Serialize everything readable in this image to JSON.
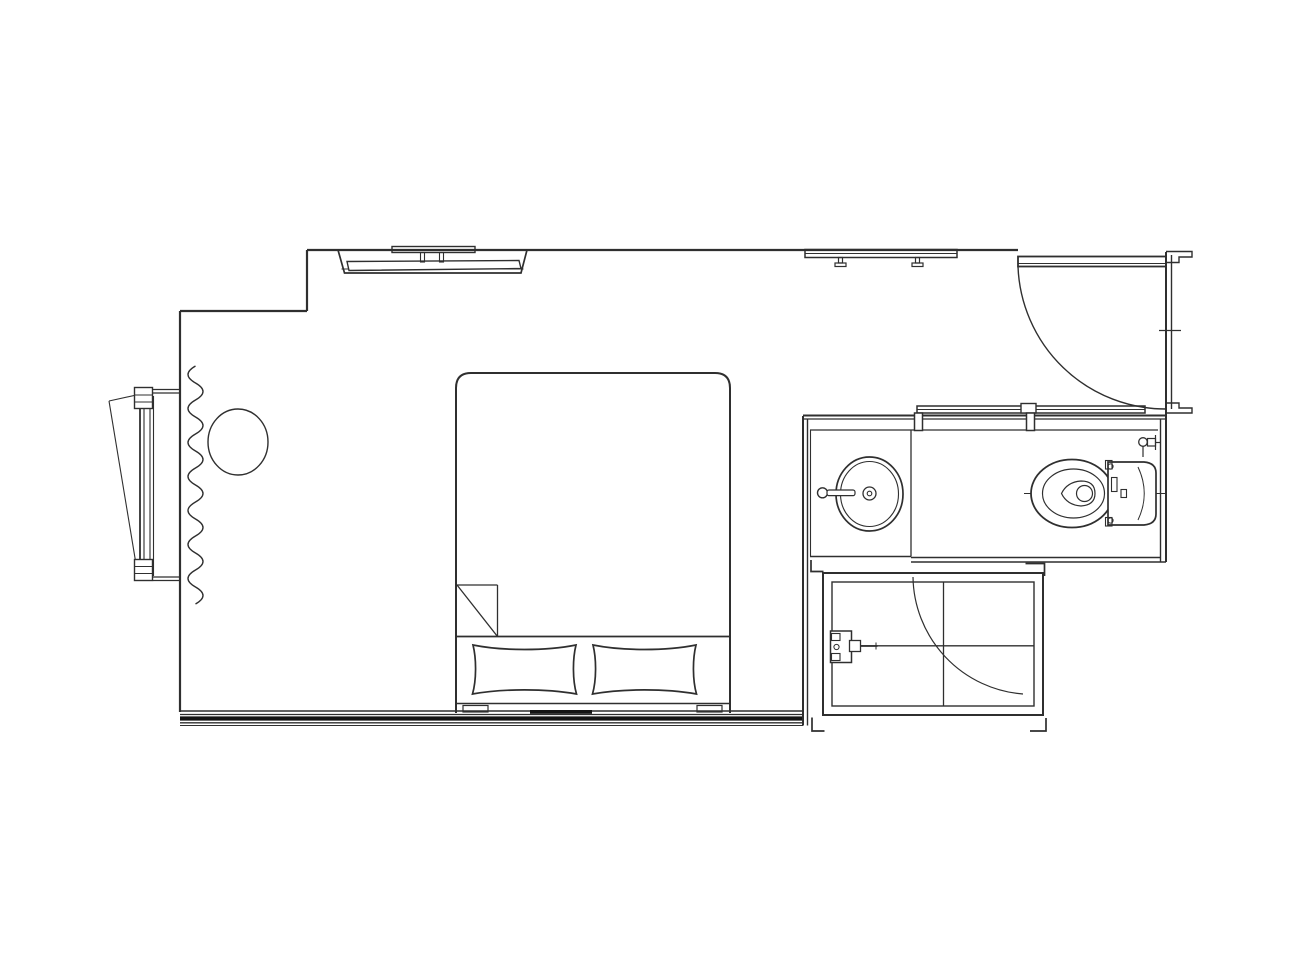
{
  "meta": {
    "description": "architectural floor plan line drawing, hotel guest room with bathroom and shower",
    "background": "#ffffff",
    "stroke": "#2f2f2f",
    "stroke_dark": "#141414",
    "canvas_width": 1300,
    "canvas_height": 975
  },
  "elements": [
    {
      "name": "bedroom-walls",
      "shapes": [
        {
          "type": "line",
          "x1": 307,
          "y1": 250,
          "x2": 1018,
          "y2": 250,
          "sw": 2.2
        },
        {
          "type": "line",
          "x1": 307,
          "y1": 250,
          "x2": 307,
          "y2": 311,
          "sw": 2.2
        },
        {
          "type": "line",
          "x1": 180,
          "y1": 311,
          "x2": 307,
          "y2": 311,
          "sw": 2.2
        },
        {
          "type": "line",
          "x1": 180,
          "y1": 311,
          "x2": 180,
          "y2": 712,
          "sw": 2.2
        }
      ]
    },
    {
      "name": "bottom-wall",
      "shapes": [
        {
          "type": "line",
          "x1": 180,
          "y1": 711,
          "x2": 803,
          "y2": 711,
          "sw": 1.6
        },
        {
          "type": "line",
          "x1": 180,
          "y1": 714.5,
          "x2": 803,
          "y2": 714.5,
          "sw": 1.2
        },
        {
          "type": "line",
          "x1": 180,
          "y1": 718.5,
          "x2": 803,
          "y2": 718.5,
          "sw": 4.2,
          "stroke": "#141414"
        },
        {
          "type": "line",
          "x1": 180,
          "y1": 722.8,
          "x2": 803,
          "y2": 722.8,
          "sw": 1.3
        },
        {
          "type": "line",
          "x1": 180,
          "y1": 725.5,
          "x2": 803,
          "y2": 725.5,
          "sw": 1.1
        }
      ]
    },
    {
      "name": "bedroom-right-wall",
      "shapes": [
        {
          "type": "line",
          "x1": 803,
          "y1": 416,
          "x2": 803,
          "y2": 725.5,
          "sw": 2
        },
        {
          "type": "line",
          "x1": 807.5,
          "y1": 419,
          "x2": 807.5,
          "y2": 725.5,
          "sw": 1.4
        }
      ]
    },
    {
      "name": "bathroom-top-wall",
      "shapes": [
        {
          "type": "line",
          "x1": 803,
          "y1": 415.5,
          "x2": 1166,
          "y2": 415.5,
          "sw": 2
        },
        {
          "type": "line",
          "x1": 803,
          "y1": 419,
          "x2": 1166,
          "y2": 419,
          "sw": 1.3
        }
      ]
    },
    {
      "name": "bathroom-right-wall",
      "shapes": [
        {
          "type": "line",
          "x1": 1160.5,
          "y1": 419,
          "x2": 1160.5,
          "y2": 562,
          "sw": 1.4
        },
        {
          "type": "line",
          "x1": 1166,
          "y1": 412,
          "x2": 1166,
          "y2": 562,
          "sw": 2
        }
      ]
    },
    {
      "name": "bathroom-bottom-wall",
      "shapes": [
        {
          "type": "line",
          "x1": 810,
          "y1": 556.5,
          "x2": 911,
          "y2": 556.5,
          "sw": 1.5
        },
        {
          "type": "line",
          "x1": 911,
          "y1": 557.5,
          "x2": 1160,
          "y2": 557.5,
          "sw": 1.5
        },
        {
          "type": "line",
          "x1": 911,
          "y1": 562,
          "x2": 1166,
          "y2": 562,
          "sw": 1.6
        }
      ]
    },
    {
      "name": "bathroom-floor-lines",
      "shapes": [
        {
          "type": "line",
          "x1": 810,
          "y1": 430,
          "x2": 1158,
          "y2": 430,
          "sw": 1.3
        },
        {
          "type": "line",
          "x1": 911,
          "y1": 430,
          "x2": 911,
          "y2": 556.5,
          "sw": 1.3
        },
        {
          "type": "line",
          "x1": 810.5,
          "y1": 430,
          "x2": 810.5,
          "y2": 556.5,
          "sw": 1.1
        }
      ]
    },
    {
      "name": "sliding-door",
      "shapes": [
        {
          "type": "rect",
          "x": 917,
          "y": 406,
          "w": 228,
          "h": 7,
          "sw": 1.5
        },
        {
          "type": "line",
          "x1": 917,
          "y1": 409.5,
          "x2": 1145,
          "y2": 409.5,
          "sw": 0.9
        },
        {
          "type": "rect",
          "x": 1021,
          "y": 403.5,
          "w": 15,
          "h": 9.5,
          "sw": 1.4,
          "fill": "#ffffff"
        },
        {
          "type": "rect",
          "x": 914.5,
          "y": 413,
          "w": 8,
          "h": 17.5,
          "sw": 1.5,
          "fill": "#ffffff"
        },
        {
          "type": "rect",
          "x": 1026.5,
          "y": 413,
          "w": 8,
          "h": 17.5,
          "sw": 1.5,
          "fill": "#ffffff"
        }
      ]
    },
    {
      "name": "entry-door",
      "shapes": [
        {
          "type": "rect",
          "x": 1018,
          "y": 256.5,
          "w": 148,
          "h": 10,
          "sw": 1.8,
          "fill": "#ffffff"
        },
        {
          "type": "line",
          "x1": 1018,
          "y1": 263.5,
          "x2": 1166,
          "y2": 263.5,
          "sw": 1
        },
        {
          "type": "path",
          "d": "M1018 266.5 A148 148 0 0 0 1166 409",
          "sw": 1.4
        }
      ]
    },
    {
      "name": "entry-door-frame",
      "shapes": [
        {
          "type": "line",
          "x1": 1166,
          "y1": 252,
          "x2": 1166,
          "y2": 412,
          "sw": 2
        },
        {
          "type": "line",
          "x1": 1171.5,
          "y1": 255,
          "x2": 1171.5,
          "y2": 409,
          "sw": 1.4
        },
        {
          "type": "path",
          "d": "M1166 251.5 H1192 V257 H1179 V262.5 H1166",
          "sw": 1.4
        },
        {
          "type": "path",
          "d": "M1166 403 H1179 V408 H1192 V413 H1166",
          "sw": 1.4
        },
        {
          "type": "line",
          "x1": 1159,
          "y1": 330.5,
          "x2": 1181,
          "y2": 330.5,
          "sw": 1.3
        }
      ]
    },
    {
      "name": "closet-rod",
      "shapes": [
        {
          "type": "rect",
          "x": 805,
          "y": 249.5,
          "w": 152,
          "h": 8,
          "sw": 1.5
        },
        {
          "type": "line",
          "x1": 805,
          "y1": 253.5,
          "x2": 957,
          "y2": 253.5,
          "sw": 0.9
        },
        {
          "type": "rect",
          "x": 838.5,
          "y": 257.5,
          "w": 4,
          "h": 5.5,
          "sw": 1.2
        },
        {
          "type": "rect",
          "x": 835,
          "y": 263,
          "w": 11,
          "h": 3.5,
          "sw": 1.2
        },
        {
          "type": "rect",
          "x": 915.5,
          "y": 257.5,
          "w": 4,
          "h": 5.5,
          "sw": 1.2
        },
        {
          "type": "rect",
          "x": 912,
          "y": 263,
          "w": 11,
          "h": 3.5,
          "sw": 1.2
        }
      ]
    },
    {
      "name": "tv-unit",
      "shapes": [
        {
          "type": "path",
          "d": "M338 250 L344.5 273 L521 273 L527 250",
          "sw": 1.7
        },
        {
          "type": "line",
          "x1": 341.5,
          "y1": 269,
          "x2": 523.5,
          "y2": 269,
          "sw": 1.1
        },
        {
          "type": "polygon",
          "points": "347,261.5 519,260.5 521,268.5 349,270.5",
          "sw": 1.4,
          "fill": "#ffffff"
        },
        {
          "type": "rect",
          "x": 392,
          "y": 246.5,
          "w": 83,
          "h": 6,
          "sw": 1.4
        },
        {
          "type": "rect",
          "x": 420.5,
          "y": 252.5,
          "w": 4,
          "h": 9.5,
          "sw": 1.1
        },
        {
          "type": "rect",
          "x": 439.5,
          "y": 252.5,
          "w": 4,
          "h": 9.5,
          "sw": 1.1
        }
      ]
    },
    {
      "name": "window",
      "shapes": [
        {
          "type": "line",
          "x1": 109,
          "y1": 401,
          "x2": 141,
          "y2": 394,
          "sw": 1.1
        },
        {
          "type": "line",
          "x1": 109,
          "y1": 401,
          "x2": 136,
          "y2": 564,
          "sw": 1.1
        },
        {
          "type": "line",
          "x1": 140,
          "y1": 392,
          "x2": 140,
          "y2": 580,
          "sw": 1.8
        },
        {
          "type": "line",
          "x1": 144,
          "y1": 392,
          "x2": 144,
          "y2": 580,
          "sw": 1.1
        },
        {
          "type": "line",
          "x1": 150,
          "y1": 396,
          "x2": 150,
          "y2": 576,
          "sw": 1.1
        },
        {
          "type": "line",
          "x1": 153.5,
          "y1": 396,
          "x2": 153.5,
          "y2": 576,
          "sw": 1.1
        },
        {
          "type": "rect",
          "x": 134.5,
          "y": 387.5,
          "w": 18,
          "h": 21,
          "sw": 1.4,
          "fill": "#ffffff"
        },
        {
          "type": "line",
          "x1": 134.5,
          "y1": 395,
          "x2": 152.5,
          "y2": 395,
          "sw": 1
        },
        {
          "type": "line",
          "x1": 134.5,
          "y1": 402,
          "x2": 152.5,
          "y2": 402,
          "sw": 1
        },
        {
          "type": "rect",
          "x": 134.5,
          "y": 559.5,
          "w": 18,
          "h": 21,
          "sw": 1.4,
          "fill": "#ffffff"
        },
        {
          "type": "line",
          "x1": 134.5,
          "y1": 566.5,
          "x2": 152.5,
          "y2": 566.5,
          "sw": 1
        },
        {
          "type": "line",
          "x1": 134.5,
          "y1": 573.5,
          "x2": 152.5,
          "y2": 573.5,
          "sw": 1
        },
        {
          "type": "line",
          "x1": 153,
          "y1": 389.5,
          "x2": 180,
          "y2": 389.5,
          "sw": 1.2
        },
        {
          "type": "line",
          "x1": 153,
          "y1": 393,
          "x2": 180,
          "y2": 393,
          "sw": 1.2
        },
        {
          "type": "line",
          "x1": 153,
          "y1": 577,
          "x2": 180,
          "y2": 577,
          "sw": 1.2
        },
        {
          "type": "line",
          "x1": 153,
          "y1": 580.5,
          "x2": 180,
          "y2": 580.5,
          "sw": 1.2
        }
      ]
    },
    {
      "name": "curtain",
      "shapes": [
        {
          "type": "path",
          "d": "M195.5 366 q-15 8.5 0 17 q15 8.5 0 17 q-15 8.5 0 17 q15 8.5 0 17 q-15 8.5 0 17 q15 8.5 0 17 q-15 8.5 0 17 q15 8.5 0 17 q-15 8.5 0 17 q15 8.5 0 17 q-15 8.5 0 17 q15 8.5 0 17 q-15 8.5 0 17 q15 8.5 0 17",
          "sw": 1.4
        }
      ]
    },
    {
      "name": "side-table",
      "shapes": [
        {
          "type": "ellipse",
          "cx": 238,
          "cy": 442,
          "rx": 30,
          "ry": 33,
          "sw": 1.4
        }
      ]
    },
    {
      "name": "bed",
      "shapes": [
        {
          "type": "path",
          "d": "M456 713 L456 388 Q456 373 471 373 L715 373 Q730 373 730 388 L730 713",
          "sw": 2
        },
        {
          "type": "line",
          "x1": 456,
          "y1": 636.5,
          "x2": 730,
          "y2": 636.5,
          "sw": 1.7
        },
        {
          "type": "line",
          "x1": 457,
          "y1": 585,
          "x2": 497.5,
          "y2": 585,
          "sw": 1.3
        },
        {
          "type": "line",
          "x1": 497.5,
          "y1": 585,
          "x2": 497.5,
          "y2": 636.5,
          "sw": 1.3
        },
        {
          "type": "line",
          "x1": 457,
          "y1": 585,
          "x2": 497.5,
          "y2": 636.5,
          "sw": 1.3
        },
        {
          "type": "line",
          "x1": 456,
          "y1": 703.5,
          "x2": 730,
          "y2": 703.5,
          "sw": 1.6
        },
        {
          "type": "rect",
          "x": 463,
          "y": 705.5,
          "w": 25,
          "h": 6.5,
          "sw": 1.2
        },
        {
          "type": "rect",
          "x": 697,
          "y": 705.5,
          "w": 25,
          "h": 6.5,
          "sw": 1.2
        },
        {
          "type": "rect",
          "x": 530,
          "y": 710,
          "w": 62,
          "h": 3.8,
          "fill": "#141414",
          "stroke": "none"
        }
      ]
    },
    {
      "name": "pillow-left",
      "shapes": [
        {
          "type": "path",
          "d": "M473 645 C503 651 546 651 576 645 C572.5 659 572.5 680 576.5 694 C546 688.5 503 688.5 472.5 694 C476.5 680 476.5 659 473 645 Z",
          "sw": 1.7,
          "fill": "#ffffff"
        }
      ]
    },
    {
      "name": "pillow-right",
      "shapes": [
        {
          "type": "path",
          "d": "M593 645 C623 651 666 651 696 645 C692.5 659 692.5 680 696.5 694 C666 688.5 623 688.5 592.5 694 C596.5 680 596.5 659 593 645 Z",
          "sw": 1.7,
          "fill": "#ffffff"
        }
      ]
    },
    {
      "name": "sink",
      "shapes": [
        {
          "type": "ellipse",
          "cx": 869.5,
          "cy": 494,
          "rx": 33.5,
          "ry": 37,
          "sw": 1.7
        },
        {
          "type": "ellipse",
          "cx": 869.5,
          "cy": 494,
          "rx": 29,
          "ry": 32.5,
          "sw": 1.1
        },
        {
          "type": "circle",
          "cx": 869.5,
          "cy": 493.5,
          "r": 6.5,
          "sw": 1.3
        },
        {
          "type": "circle",
          "cx": 869.5,
          "cy": 493.5,
          "r": 2.3,
          "sw": 1.1
        },
        {
          "type": "circle",
          "cx": 822.5,
          "cy": 492.8,
          "r": 5,
          "sw": 1.4
        },
        {
          "type": "rect",
          "x": 827,
          "y": 490,
          "w": 28,
          "h": 5.6,
          "rx": 2,
          "sw": 1.2,
          "fill": "#ffffff"
        }
      ]
    },
    {
      "name": "toilet",
      "shapes": [
        {
          "type": "line",
          "x1": 1024,
          "y1": 493.5,
          "x2": 1167,
          "y2": 493.5,
          "sw": 0.9
        },
        {
          "type": "ellipse",
          "cx": 1072,
          "cy": 493.5,
          "rx": 41,
          "ry": 34,
          "sw": 1.8,
          "fill": "#ffffff"
        },
        {
          "type": "ellipse",
          "cx": 1073.5,
          "cy": 493.5,
          "rx": 31,
          "ry": 24.5,
          "sw": 1.2
        },
        {
          "type": "path",
          "d": "M1095 493.5 Q1095 481 1081 481 Q1067 482 1061.5 493.5 Q1067 505 1081 506 Q1095 505 1095 493.5 Z",
          "sw": 1.2
        },
        {
          "type": "circle",
          "cx": 1084.5,
          "cy": 493.5,
          "r": 8,
          "sw": 1.2
        },
        {
          "type": "path",
          "d": "M1108 462 L1144 462 Q1156 463 1156 473 L1156 514 Q1156 524 1144 525 L1108 525 Z",
          "sw": 1.7,
          "fill": "#ffffff"
        },
        {
          "type": "rect",
          "x": 1105.5,
          "y": 460.5,
          "w": 6.5,
          "h": 8.5,
          "sw": 1.1
        },
        {
          "type": "rect",
          "x": 1105.5,
          "y": 517.5,
          "w": 6.5,
          "h": 8.5,
          "sw": 1.1
        },
        {
          "type": "rect",
          "x": 1111.5,
          "y": 477.5,
          "w": 5.5,
          "h": 14,
          "sw": 1.1
        },
        {
          "type": "rect",
          "x": 1121,
          "y": 489.5,
          "w": 5.5,
          "h": 8,
          "sw": 1.1
        },
        {
          "type": "path",
          "d": "M1138 467 Q1150.5 493.5 1138 520",
          "sw": 1
        },
        {
          "type": "circle",
          "cx": 1110.5,
          "cy": 466.5,
          "r": 2.6,
          "sw": 1
        },
        {
          "type": "circle",
          "cx": 1110.5,
          "cy": 520.5,
          "r": 2.6,
          "sw": 1
        }
      ]
    },
    {
      "name": "toilet-supply-valve",
      "shapes": [
        {
          "type": "line",
          "x1": 1143,
          "y1": 446.5,
          "x2": 1143,
          "y2": 457,
          "sw": 1.2
        },
        {
          "type": "circle",
          "cx": 1143,
          "cy": 442,
          "r": 4.3,
          "sw": 1.3
        },
        {
          "type": "rect",
          "x": 1147.5,
          "y": 438.5,
          "w": 8,
          "h": 7.5,
          "sw": 1.2
        },
        {
          "type": "line",
          "x1": 1155.5,
          "y1": 435,
          "x2": 1155.5,
          "y2": 450,
          "sw": 1.2
        },
        {
          "type": "line",
          "x1": 1155.5,
          "y1": 442.5,
          "x2": 1161,
          "y2": 442.5,
          "sw": 1.2
        }
      ]
    },
    {
      "name": "shower-enclosure",
      "shapes": [
        {
          "type": "rect",
          "x": 823,
          "y": 573,
          "w": 220,
          "h": 142,
          "sw": 2
        },
        {
          "type": "rect",
          "x": 832,
          "y": 582,
          "w": 202,
          "h": 124,
          "sw": 1.4
        },
        {
          "type": "line",
          "x1": 943.5,
          "y1": 582,
          "x2": 943.5,
          "y2": 706,
          "sw": 1.3
        },
        {
          "type": "line",
          "x1": 832,
          "y1": 645.8,
          "x2": 1034,
          "y2": 645.8,
          "sw": 1.3
        },
        {
          "type": "path",
          "d": "M913 577 A119 119 0 0 0 1023 694",
          "sw": 1.2
        }
      ]
    },
    {
      "name": "shower-valve",
      "shapes": [
        {
          "type": "rect",
          "x": 830.5,
          "y": 631,
          "w": 21,
          "h": 31.5,
          "sw": 1.5,
          "fill": "#ffffff"
        },
        {
          "type": "rect",
          "x": 831.5,
          "y": 633.5,
          "w": 8.5,
          "h": 7,
          "sw": 1.1
        },
        {
          "type": "rect",
          "x": 831.5,
          "y": 653.5,
          "w": 8.5,
          "h": 7,
          "sw": 1.1
        },
        {
          "type": "circle",
          "cx": 836.5,
          "cy": 647,
          "r": 2.6,
          "sw": 1
        },
        {
          "type": "rect",
          "x": 849.5,
          "y": 640.5,
          "w": 11,
          "h": 11,
          "sw": 1.3,
          "fill": "#ffffff"
        },
        {
          "type": "line",
          "x1": 860.5,
          "y1": 646,
          "x2": 877.5,
          "y2": 646,
          "sw": 1.8
        },
        {
          "type": "line",
          "x1": 876,
          "y1": 642.5,
          "x2": 876,
          "y2": 649.5,
          "sw": 1
        }
      ]
    },
    {
      "name": "shower-corner-marks",
      "shapes": [
        {
          "type": "path",
          "d": "M811 560 L811 571.5 L823.5 571.5",
          "sw": 1.7
        },
        {
          "type": "path",
          "d": "M1025.5 563.5 L1044.5 563.5 L1044.5 576",
          "sw": 1.7
        },
        {
          "type": "path",
          "d": "M812 717.5 L812 731 L824.5 731",
          "sw": 1.7
        },
        {
          "type": "path",
          "d": "M1046 718 L1046 731 L1030 731",
          "sw": 1.7
        }
      ]
    }
  ]
}
